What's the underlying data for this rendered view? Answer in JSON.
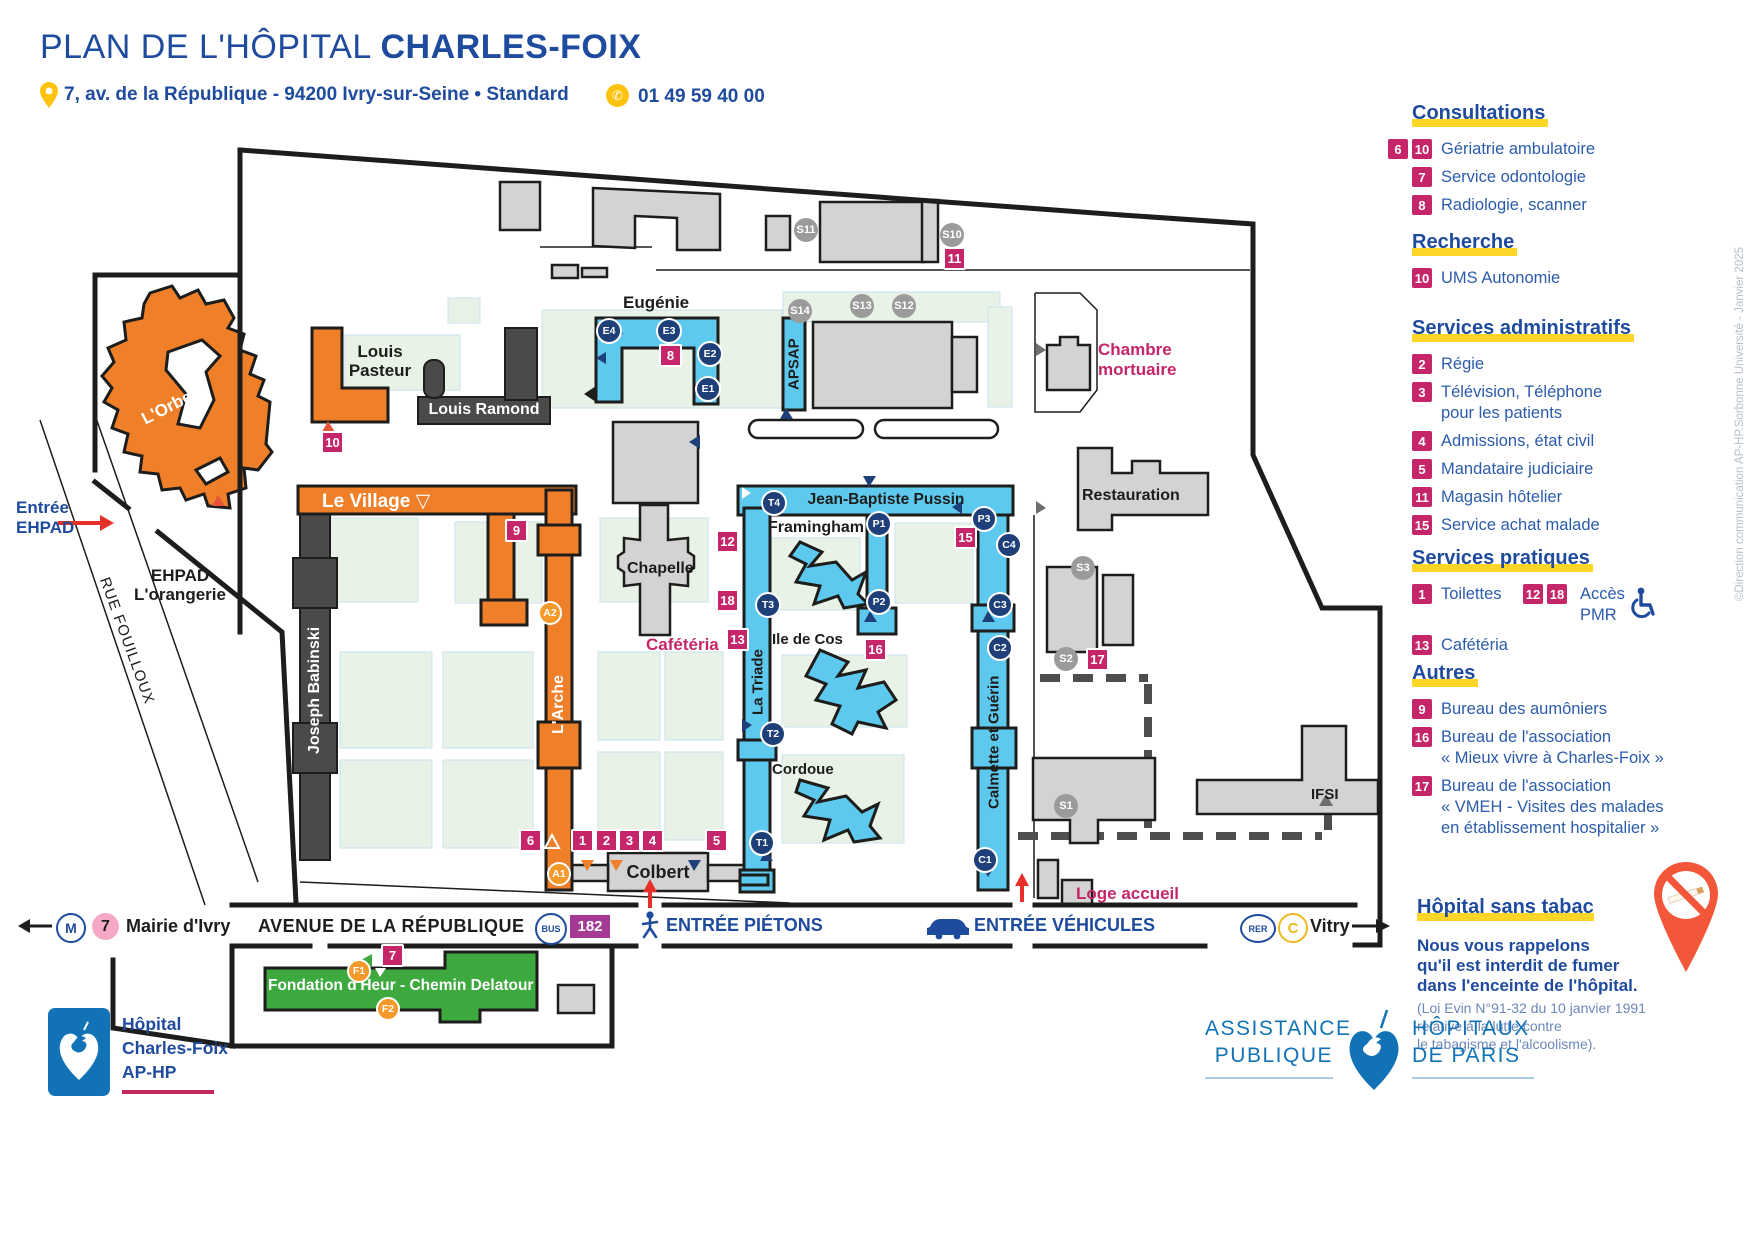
{
  "header": {
    "title_prefix": "PLAN DE L'HÔPITAL ",
    "title_name": "CHARLES-FOIX",
    "address": "7, av. de la République - 94200 Ivry-sur-Seine • Standard",
    "phone": "01 49 59 40 00"
  },
  "legend": {
    "consultations": {
      "title": "Consultations",
      "items": [
        {
          "badges": [
            "6",
            "10"
          ],
          "lines": [
            "Gériatrie ambulatoire"
          ]
        },
        {
          "badges": [
            "7"
          ],
          "lines": [
            "Service odontologie"
          ]
        },
        {
          "badges": [
            "8"
          ],
          "lines": [
            "Radiologie, scanner"
          ]
        }
      ]
    },
    "recherche": {
      "title": "Recherche",
      "items": [
        {
          "badges": [
            "10"
          ],
          "lines": [
            "UMS Autonomie"
          ]
        }
      ]
    },
    "administratifs": {
      "title": "Services administratifs",
      "items": [
        {
          "badges": [
            "2"
          ],
          "lines": [
            "Régie"
          ]
        },
        {
          "badges": [
            "3"
          ],
          "lines": [
            "Télévision, Téléphone",
            "pour les patients"
          ]
        },
        {
          "badges": [
            "4"
          ],
          "lines": [
            "Admissions, état civil"
          ]
        },
        {
          "badges": [
            "5"
          ],
          "lines": [
            "Mandataire judiciaire"
          ]
        },
        {
          "badges": [
            "11"
          ],
          "lines": [
            "Magasin hôtelier"
          ]
        },
        {
          "badges": [
            "15"
          ],
          "lines": [
            "Service achat malade"
          ]
        }
      ]
    },
    "pratiques": {
      "title": "Services pratiques",
      "toilettes": {
        "badge": "1",
        "label": "Toilettes"
      },
      "pmr": {
        "badges": [
          "12",
          "18"
        ],
        "line1": "Accès",
        "line2": "PMR"
      },
      "cafeteria": {
        "badge": "13",
        "label": "Cafétéria"
      }
    },
    "autres": {
      "title": "Autres",
      "items": [
        {
          "badges": [
            "9"
          ],
          "lines": [
            "Bureau des aumôniers"
          ]
        },
        {
          "badges": [
            "16"
          ],
          "lines": [
            "Bureau de l'association",
            "« Mieux vivre à Charles-Foix »"
          ]
        },
        {
          "badges": [
            "17"
          ],
          "lines": [
            "Bureau de l'association",
            "« VMEH - Visites des malades",
            "en établissement hospitalier »"
          ]
        }
      ]
    },
    "tabac": {
      "title": "Hôpital sans tabac",
      "lines": [
        "Nous vous rappelons",
        "qu'il est interdit de fumer",
        "dans l'enceinte de l'hôpital."
      ],
      "note": [
        "(Loi Evin N°91-32 du 10 janvier 1991",
        "relative à la lutte contre",
        "le tabagisme et l'alcoolisme)."
      ]
    }
  },
  "map": {
    "areas": {
      "eugenie": "Eugénie",
      "louis_pasteur": [
        "Louis",
        "Pasteur"
      ],
      "louis_ramond": "Louis Ramond",
      "joseph_babinski": "Joseph Babinski",
      "le_village": "Le Village",
      "orbe": "L'Orbe",
      "arche": "L'Arche",
      "apsap": "APSAP",
      "pussin": "Jean-Baptiste Pussin",
      "framingham": "Framingham",
      "ile_de_cos": "Ile de Cos",
      "cordoue": "Cordoue",
      "triade": "La Triade",
      "calmette": "Calmette et Guérin",
      "chapelle": "Chapelle",
      "cafeteria": "Cafétéria",
      "chambre": [
        "Chambre",
        "mortuaire"
      ],
      "restauration": "Restauration",
      "colbert": "Colbert",
      "ifsi": "IFSI",
      "loge": "Loge accueil",
      "ehpad": [
        "EHPAD",
        "L'orangerie"
      ],
      "entree_ehpad": [
        "Entrée",
        "EHPAD"
      ],
      "fondation": "Fondation d'Heur - Chemin Delatour",
      "rue": "RUE FOUILLOUX"
    },
    "badges": {
      "n1": "1",
      "n2": "2",
      "n3": "3",
      "n4": "4",
      "n5": "5",
      "n6": "6",
      "n7": "7",
      "n8": "8",
      "n9": "9",
      "n10": "10",
      "n11": "11",
      "n12": "12",
      "n13": "13",
      "n15": "15",
      "n16": "16",
      "n17": "17",
      "n18": "18"
    },
    "circles": {
      "e1": "E1",
      "e2": "E2",
      "e3": "E3",
      "e4": "E4",
      "t1": "T1",
      "t2": "T2",
      "t3": "T3",
      "t4": "T4",
      "p1": "P1",
      "p2": "P2",
      "p3": "P3",
      "c1": "C1",
      "c2": "C2",
      "c3": "C3",
      "c4": "C4",
      "a1": "A1",
      "a2": "A2",
      "f1": "F1",
      "f2": "F2",
      "s1": "S1",
      "s2": "S2",
      "s3": "S3",
      "s10": "S10",
      "s11": "S11",
      "s12": "S12",
      "s13": "S13",
      "s14": "S14"
    },
    "transit": {
      "metro": "M",
      "metro_line": "7",
      "metro_station": "Mairie d'Ivry",
      "avenue": "AVENUE DE LA RÉPUBLIQUE",
      "bus": "BUS",
      "bus_line": "182",
      "entree_pietons": "ENTRÉE PIÉTONS",
      "entree_vehicules": "ENTRÉE VÉHICULES",
      "rer": "RER",
      "rer_line": "C",
      "rer_station": "Vitry"
    }
  },
  "footer": {
    "hospital": [
      "Hôpital",
      "Charles-Foix",
      "AP-HP"
    ],
    "aphp": {
      "l1": "ASSISTANCE",
      "l2": "PUBLIQUE",
      "r1": "HÔPITAUX",
      "r2": "DE PARIS"
    }
  },
  "watermark": "©Direction communication AP-HP.Sorbonne Université - Janvier 2025"
}
